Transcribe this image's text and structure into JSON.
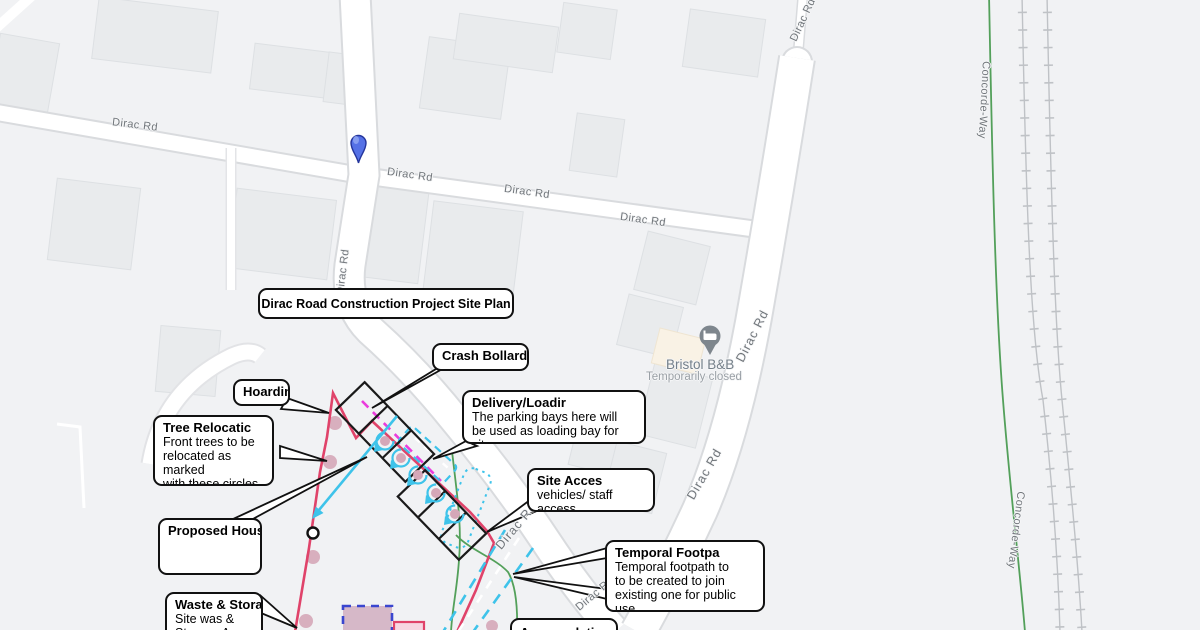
{
  "map": {
    "road_label": "Dirac Rd",
    "path_label": "Concorde-Way",
    "poi": {
      "name": "Bristol B&B",
      "status": "Temporarily closed"
    }
  },
  "callouts": {
    "title": {
      "label": "Dirac Road Construction Project Site Plan"
    },
    "crash_bollard": {
      "title": "Crash Bollard"
    },
    "hoarding": {
      "title": "Hoardin"
    },
    "tree_relocation": {
      "title": "Tree Relocatic",
      "body": "Front trees to be\nrelocated as marked\nwith these circles"
    },
    "proposed_house": {
      "title": "Proposed House"
    },
    "waste_storage": {
      "title": "Waste & Storag",
      "body": "Site was &\nStorage Area"
    },
    "delivery_loading": {
      "title": "Delivery/Loadir",
      "body": "The parking bays here will\nbe used as loading bay for site"
    },
    "site_access": {
      "title": "Site Acces",
      "body": "vehicles/ staff access"
    },
    "temporal_footpath": {
      "title": "Temporal Footpa",
      "body": "Temporal footpath to\nto be created to join\nexisting one for public use."
    },
    "accommodation": {
      "title": "Accomodatio"
    }
  },
  "colors": {
    "site_boundary": "#e0436a",
    "crash_bollard": "#ea3cdc",
    "construction_cyan": "#3ec3ea",
    "waste_area_border": "#3a46cf",
    "tree_fill": "#d5a7b8",
    "footpath_green": "#53a05a",
    "pin_blue": "#5571e6",
    "house_outline": "#1a1a1a"
  }
}
